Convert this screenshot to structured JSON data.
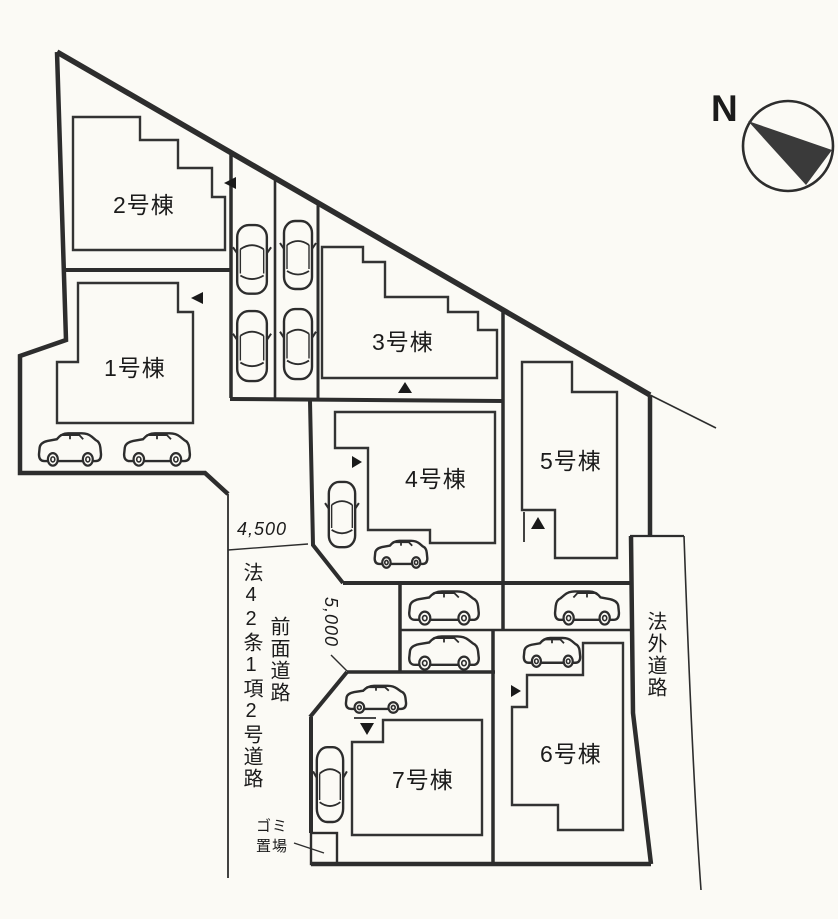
{
  "compass": {
    "north_label": "N"
  },
  "buildings": [
    {
      "id": "1",
      "label": "1号棟"
    },
    {
      "id": "2",
      "label": "2号棟"
    },
    {
      "id": "3",
      "label": "3号棟"
    },
    {
      "id": "4",
      "label": "4号棟"
    },
    {
      "id": "5",
      "label": "5号棟"
    },
    {
      "id": "6",
      "label": "6号棟"
    },
    {
      "id": "7",
      "label": "7号棟"
    }
  ],
  "roads": {
    "front_road_statute": "法42条1項2号道路",
    "front_road": "前面道路",
    "outside_road": "法外道路"
  },
  "dimensions": {
    "front_road_width": "4,500",
    "south_access_width": "5,000"
  },
  "garbage": {
    "line1": "ゴミ",
    "line2": "置場"
  },
  "colors": {
    "line": "#2d2d2d",
    "paper": "#fbfaf5",
    "ink": "#1b1b1b"
  }
}
